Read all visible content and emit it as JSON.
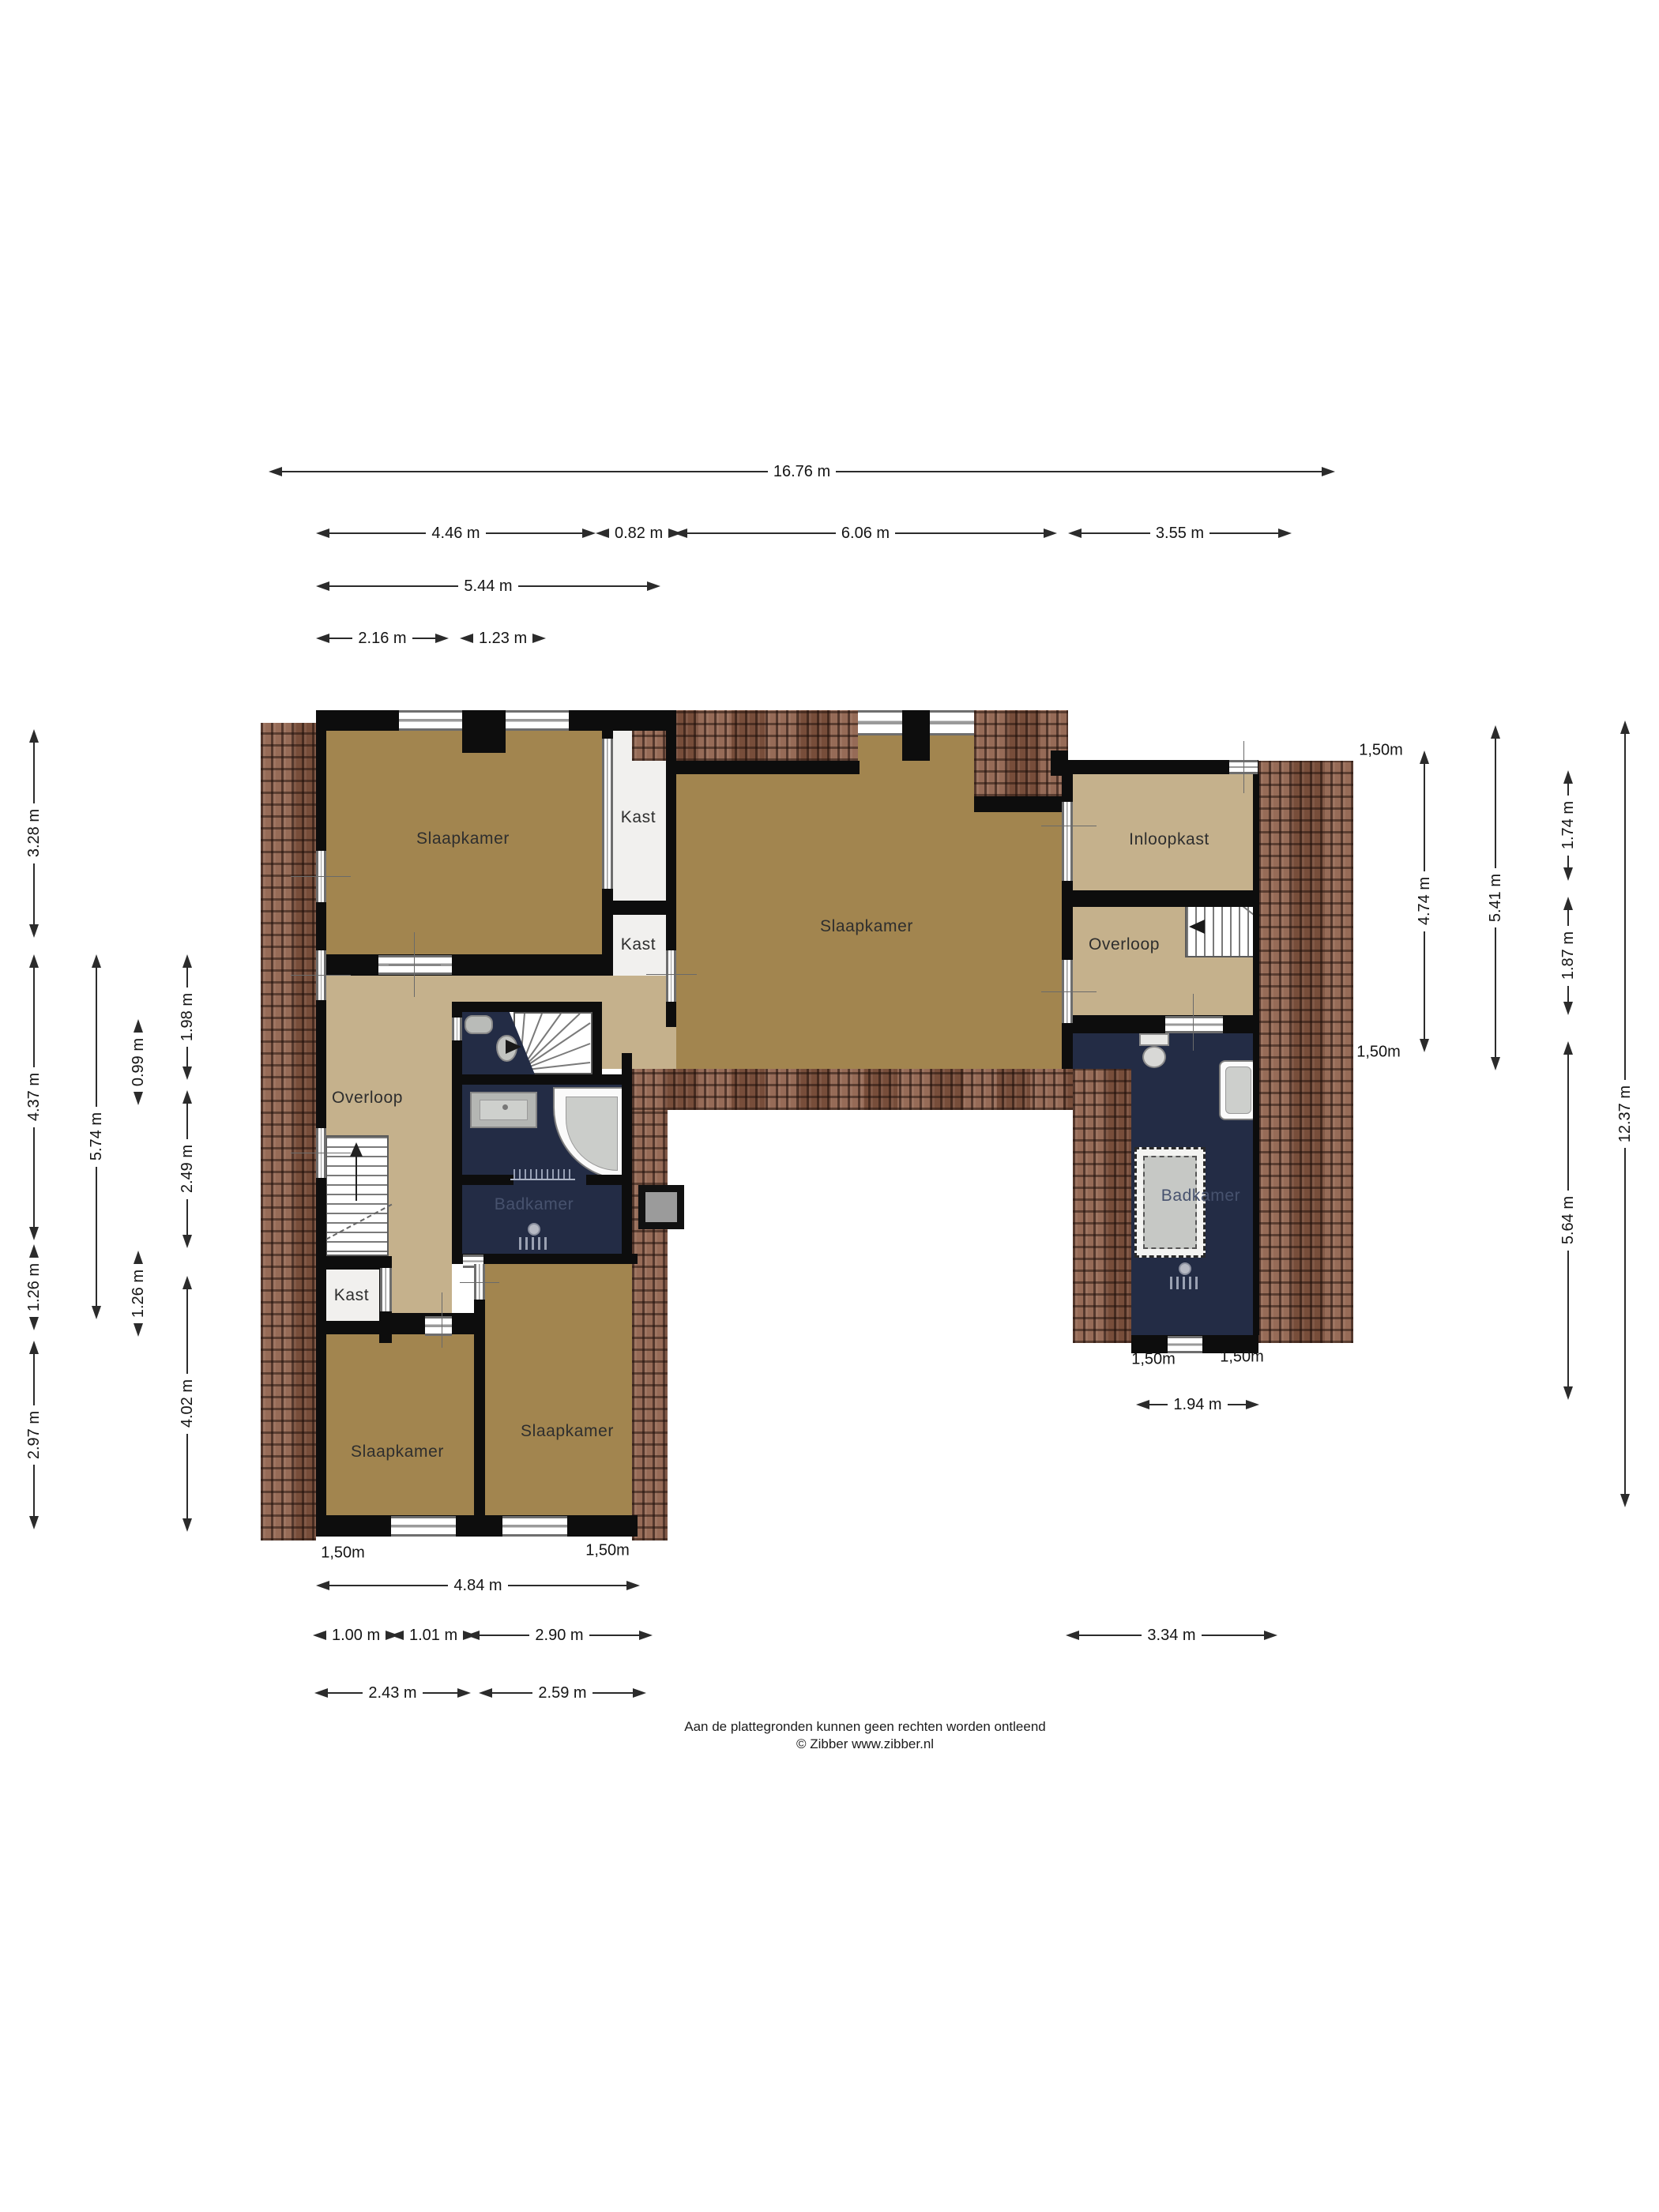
{
  "rooms": {
    "bedroom": "Slaapkamer",
    "closet": "Kast",
    "landing": "Overloop",
    "walkin_closet": "Inloopkast",
    "bathroom": "Badkamer"
  },
  "dims": {
    "top_total": "16.76 m",
    "top_a": "4.46 m",
    "top_b": "0.82 m",
    "top_c": "6.06 m",
    "top_d": "3.55 m",
    "top_e": "5.44 m",
    "top_f": "2.16 m",
    "top_g": "1.23 m",
    "left_a": "3.28 m",
    "left_b": "4.37 m",
    "left_c": "1.26 m",
    "left_d": "2.97 m",
    "left_e": "5.74 m",
    "left_f": "0.99 m",
    "left_g": "1.26 m",
    "left_h": "1.98 m",
    "left_i": "2.49 m",
    "left_j": "4.02 m",
    "right_a": "4.74 m",
    "right_b": "5.41 m",
    "right_c": "1.74 m",
    "right_d": "1.87 m",
    "right_e": "5.64 m",
    "right_f": "12.37 m",
    "bottom_a": "4.84 m",
    "bottom_b": "1.00 m",
    "bottom_c": "1.01 m",
    "bottom_d": "2.90 m",
    "bottom_e": "3.34 m",
    "bottom_f": "2.43 m",
    "bottom_g": "2.59 m",
    "bottom_h": "1.94 m",
    "clearance": "1,50m"
  },
  "colors": {
    "roof": "#8a5a44",
    "wall": "#0d0d0d",
    "floor_dark": "#a2854f",
    "floor_light": "#c5b18c",
    "bathroom": "#232c45"
  },
  "footer": {
    "line1": "Aan de plattegronden kunnen geen rechten worden ontleend",
    "line2": "© Zibber www.zibber.nl"
  }
}
